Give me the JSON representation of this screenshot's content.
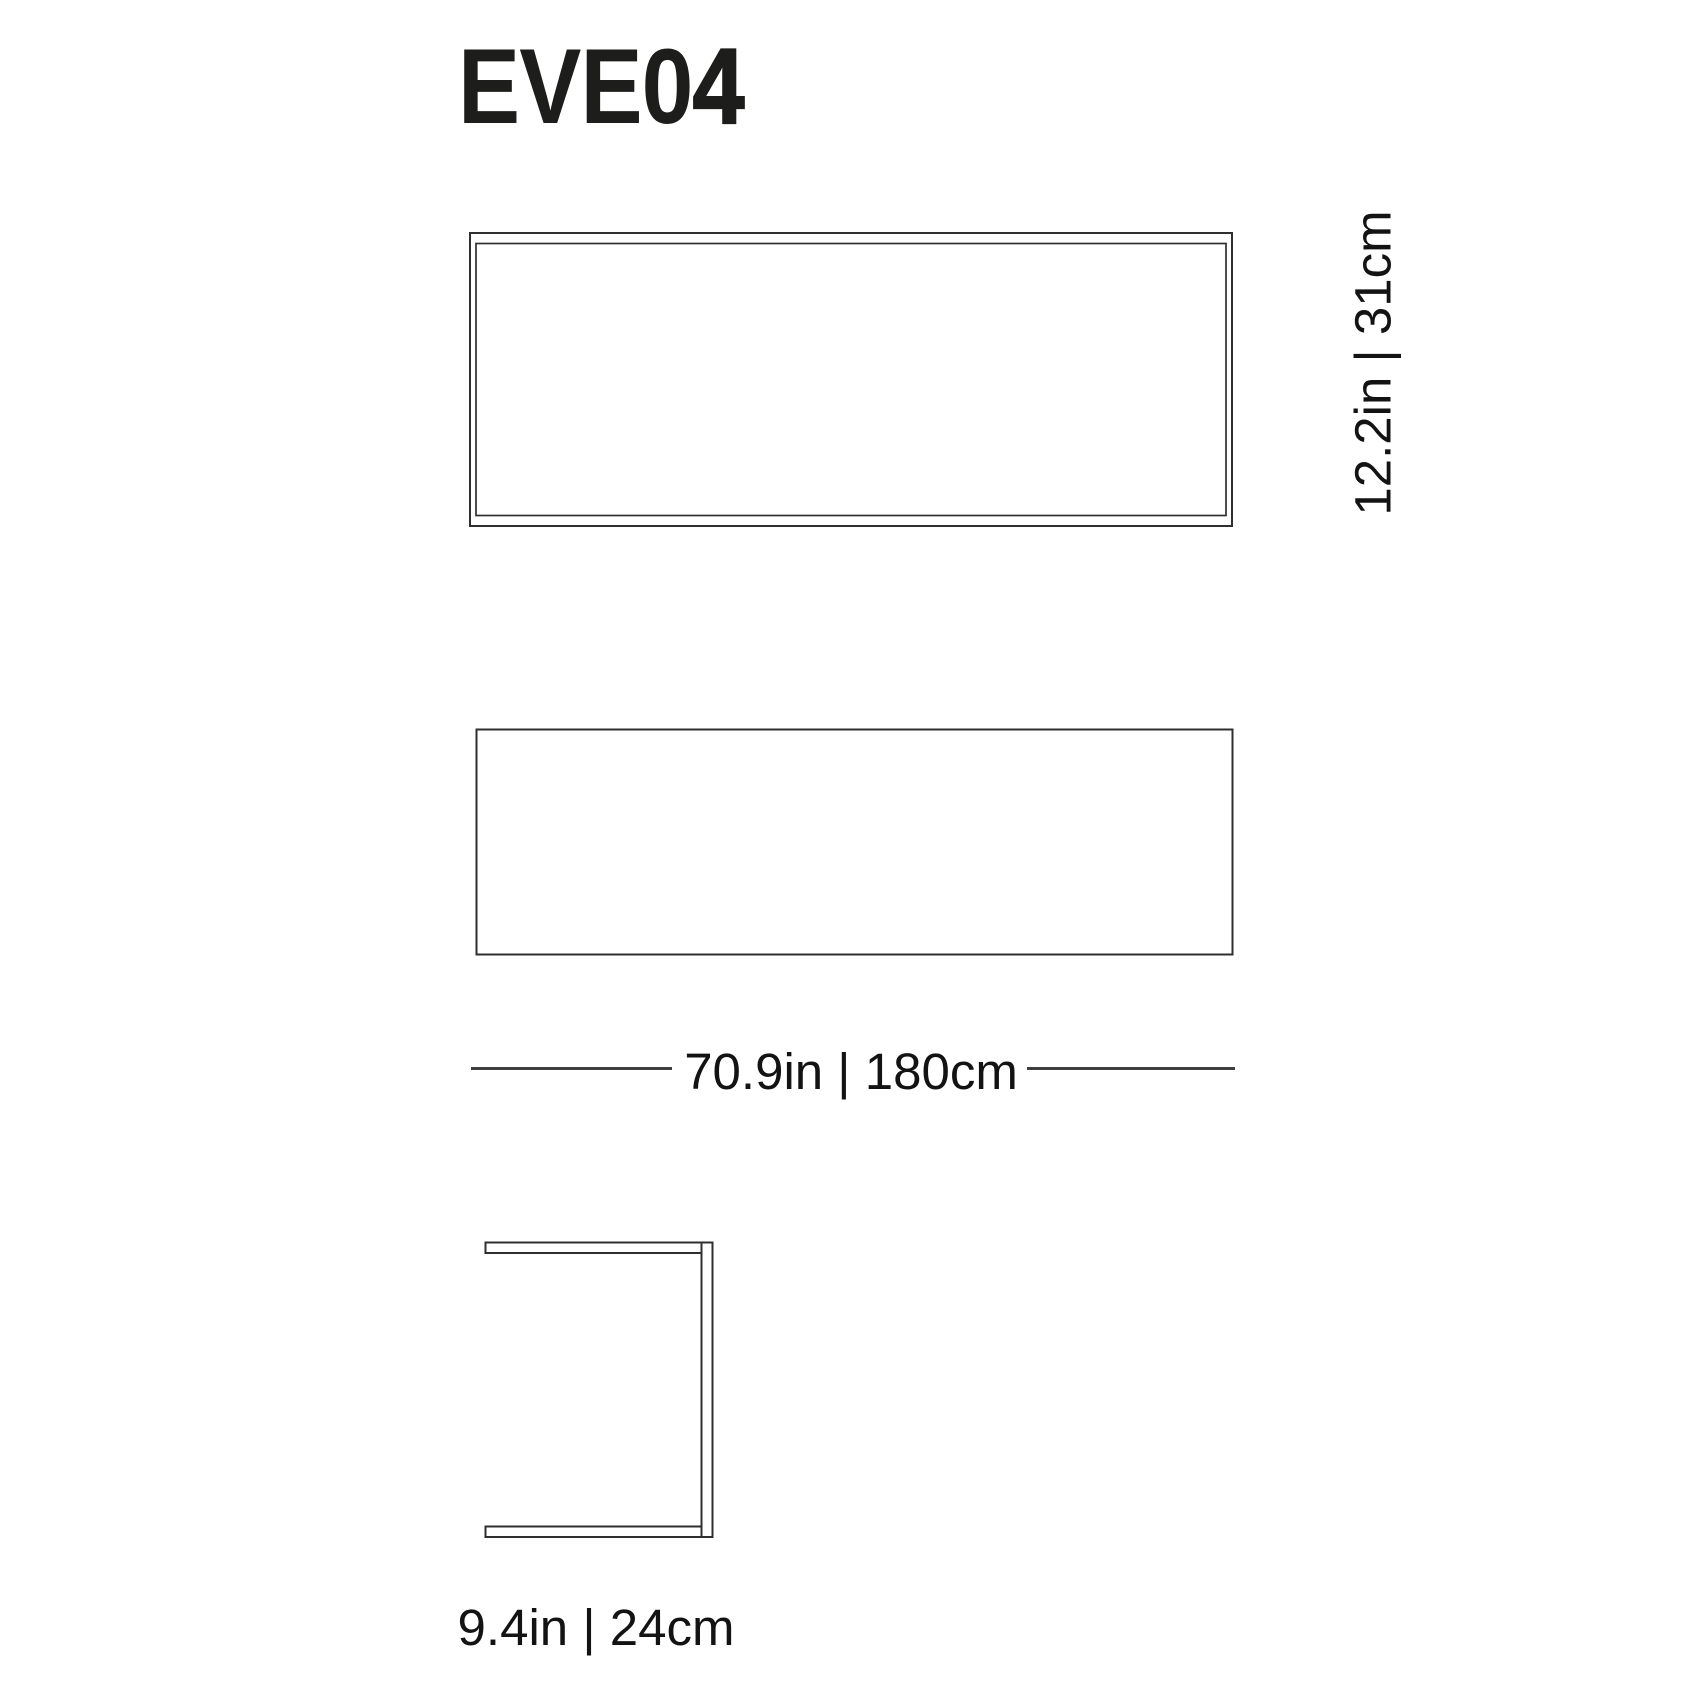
{
  "product": {
    "code": "EVE04",
    "code_prefix": "EVE0",
    "code_suffix": "4"
  },
  "dimensions": {
    "width": {
      "label": "70.9in | 180cm",
      "inches": 70.9,
      "cm": 180
    },
    "height": {
      "label": "12.2in | 31cm",
      "inches": 12.2,
      "cm": 31
    },
    "depth": {
      "label": "9.4in | 24cm",
      "inches": 9.4,
      "cm": 24
    }
  },
  "colors": {
    "background": "#ffffff",
    "text": "#131313",
    "title_text": "#1d1d1b",
    "drawing_line": "#2f2f2f",
    "dimension_line": "#3f3f3f"
  }
}
